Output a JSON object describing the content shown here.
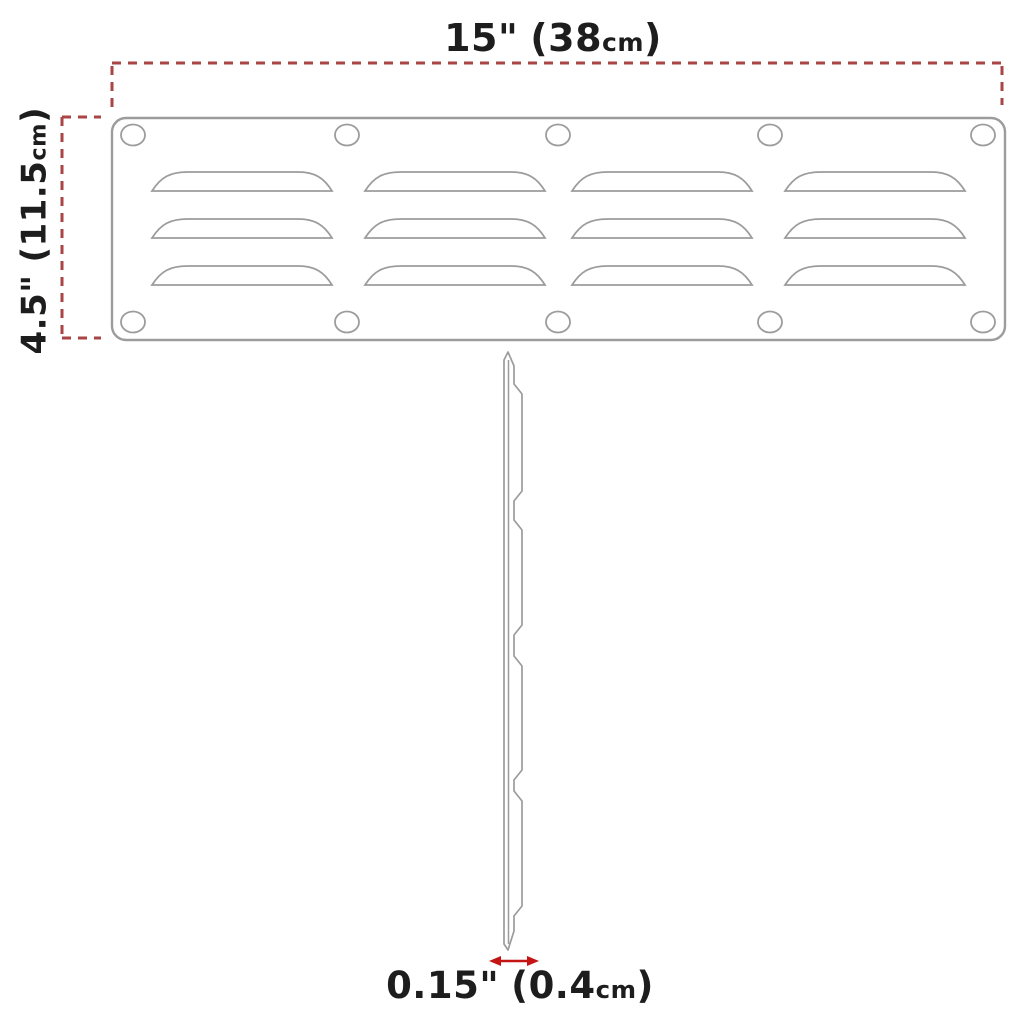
{
  "meta": {
    "background": "#ffffff",
    "line_color": "#9c9c9c",
    "dash_color": "#a94545",
    "arrow_color": "#c41414",
    "text_color": "#1d1d1d"
  },
  "dimensions": {
    "width": {
      "inches": "15\"",
      "open": "(",
      "cm": "38",
      "unit": "cm",
      "close": ")"
    },
    "height": {
      "inches": "4.5\"",
      "open": "(",
      "cm": "11.5",
      "unit": "cm",
      "close": ")"
    },
    "thickness": {
      "inches": "0.15\"",
      "open": "(",
      "cm": "0.4",
      "unit": "cm",
      "close": ")"
    }
  }
}
